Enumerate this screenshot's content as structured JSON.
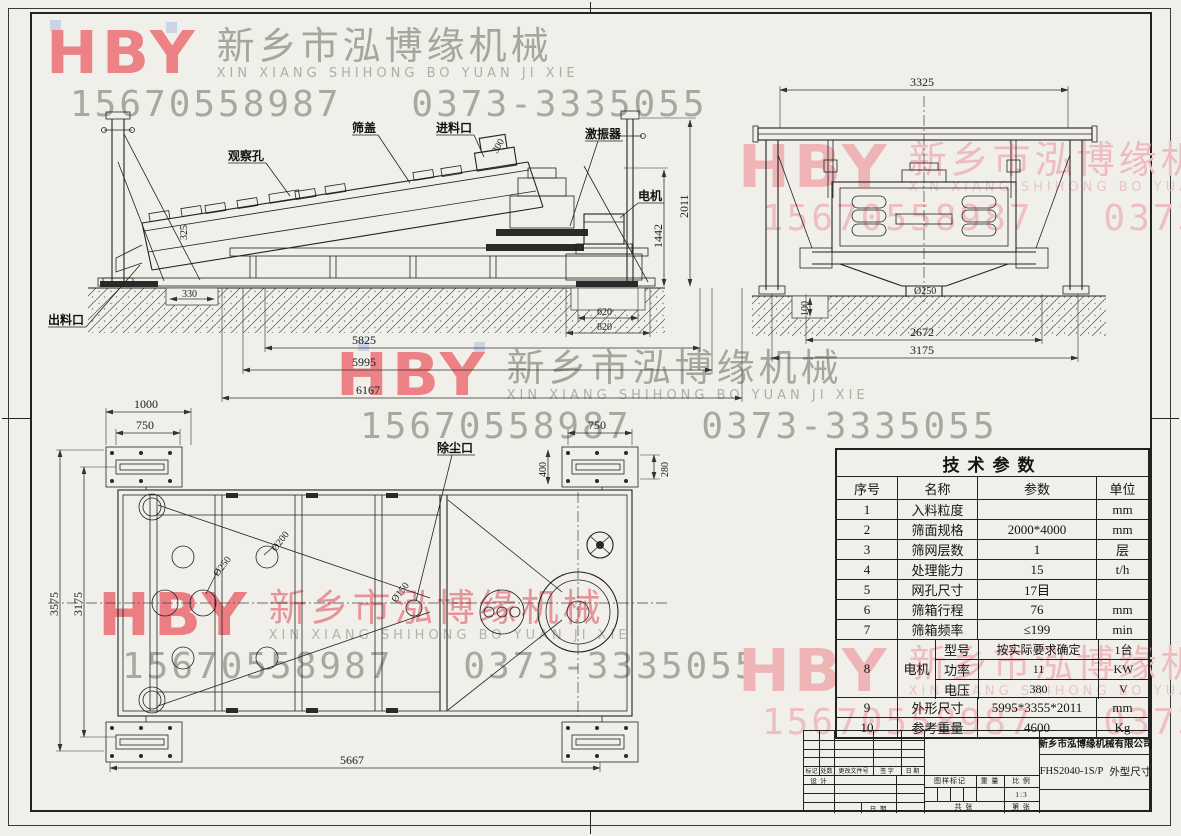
{
  "watermark": {
    "logo": "HBY",
    "company_cn": "新乡市泓博缘机械",
    "company_en": "XIN XIANG SHIHONG BO YUAN JI XIE",
    "phone_mobile": "15670558987",
    "phone_tel": "0373-3335055"
  },
  "side_view": {
    "labels": {
      "observation_hole": "观察孔",
      "screen_cover": "筛盖",
      "feed_inlet": "进料口",
      "exciter": "激振器",
      "motor": "电机",
      "discharge_outlet": "出料口"
    },
    "dims": {
      "feed_opening": "300",
      "deck": "325",
      "total_height": "2011",
      "motor_height": "1442",
      "pit_330": "330",
      "pit_620": "620",
      "pit_820": "820",
      "len_5825": "5825",
      "len_5995": "5995",
      "len_6167": "6167"
    }
  },
  "front_view": {
    "dims": {
      "width_3325": "3325",
      "outlet_d250": "Ø250",
      "depth_100": "100",
      "span_2672": "2672",
      "span_3175": "3175"
    }
  },
  "top_view": {
    "labels": {
      "dust_port": "除尘口"
    },
    "dims": {
      "plate_1000": "1000",
      "plate_750_left": "750",
      "plate_750_right": "750",
      "plate_400": "400",
      "plate_280": "280",
      "width_3575": "3575",
      "width_3175": "3175",
      "len_5667": "5667",
      "hole_250": "Ø250",
      "hole_200": "Ø200",
      "hole_150": "Ø150"
    }
  },
  "params_table": {
    "title": "技术参数",
    "headers": {
      "no": "序号",
      "name": "名称",
      "value": "参数",
      "unit": "单位"
    },
    "rows": [
      {
        "no": "1",
        "name": "入料粒度",
        "value": "",
        "unit": "mm"
      },
      {
        "no": "2",
        "name": "筛面规格",
        "value": "2000*4000",
        "unit": "mm"
      },
      {
        "no": "3",
        "name": "筛网层数",
        "value": "1",
        "unit": "层"
      },
      {
        "no": "4",
        "name": "处理能力",
        "value": "15",
        "unit": "t/h"
      },
      {
        "no": "5",
        "name": "网孔尺寸",
        "value": "17目",
        "unit": ""
      },
      {
        "no": "6",
        "name": "筛箱行程",
        "value": "76",
        "unit": "mm"
      },
      {
        "no": "7",
        "name": "筛箱频率",
        "value": "≤199",
        "unit": "min"
      }
    ],
    "motor": {
      "no": "8",
      "name": "电机",
      "rows": [
        {
          "name": "型号",
          "value": "按实际要求确定",
          "unit": "1台"
        },
        {
          "name": "功率",
          "value": "11",
          "unit": "KW"
        },
        {
          "name": "电压",
          "value": "380",
          "unit": "V"
        }
      ]
    },
    "tail_rows": [
      {
        "no": "9",
        "name": "外形尺寸",
        "value": "5995*3355*2011",
        "unit": "mm"
      },
      {
        "no": "10",
        "name": "参考重量",
        "value": "4600",
        "unit": "Kg"
      }
    ]
  },
  "title_block": {
    "company": "新乡市泓博缘机械有限公司",
    "drawing_no": "FHS2040-1S/P",
    "drawing_title": "外型尺寸",
    "scale_value": "1:3",
    "labels": {
      "mark": "标记",
      "count": "处数",
      "change_file": "更改文件号",
      "sign": "签 字",
      "date": "日 期",
      "design": "设 计",
      "date2": "日 期",
      "drawing_mark": "图样标记",
      "weight": "重 量",
      "scale": "比 例",
      "sheets_total": "共  张",
      "sheet_no": "第  张"
    }
  }
}
